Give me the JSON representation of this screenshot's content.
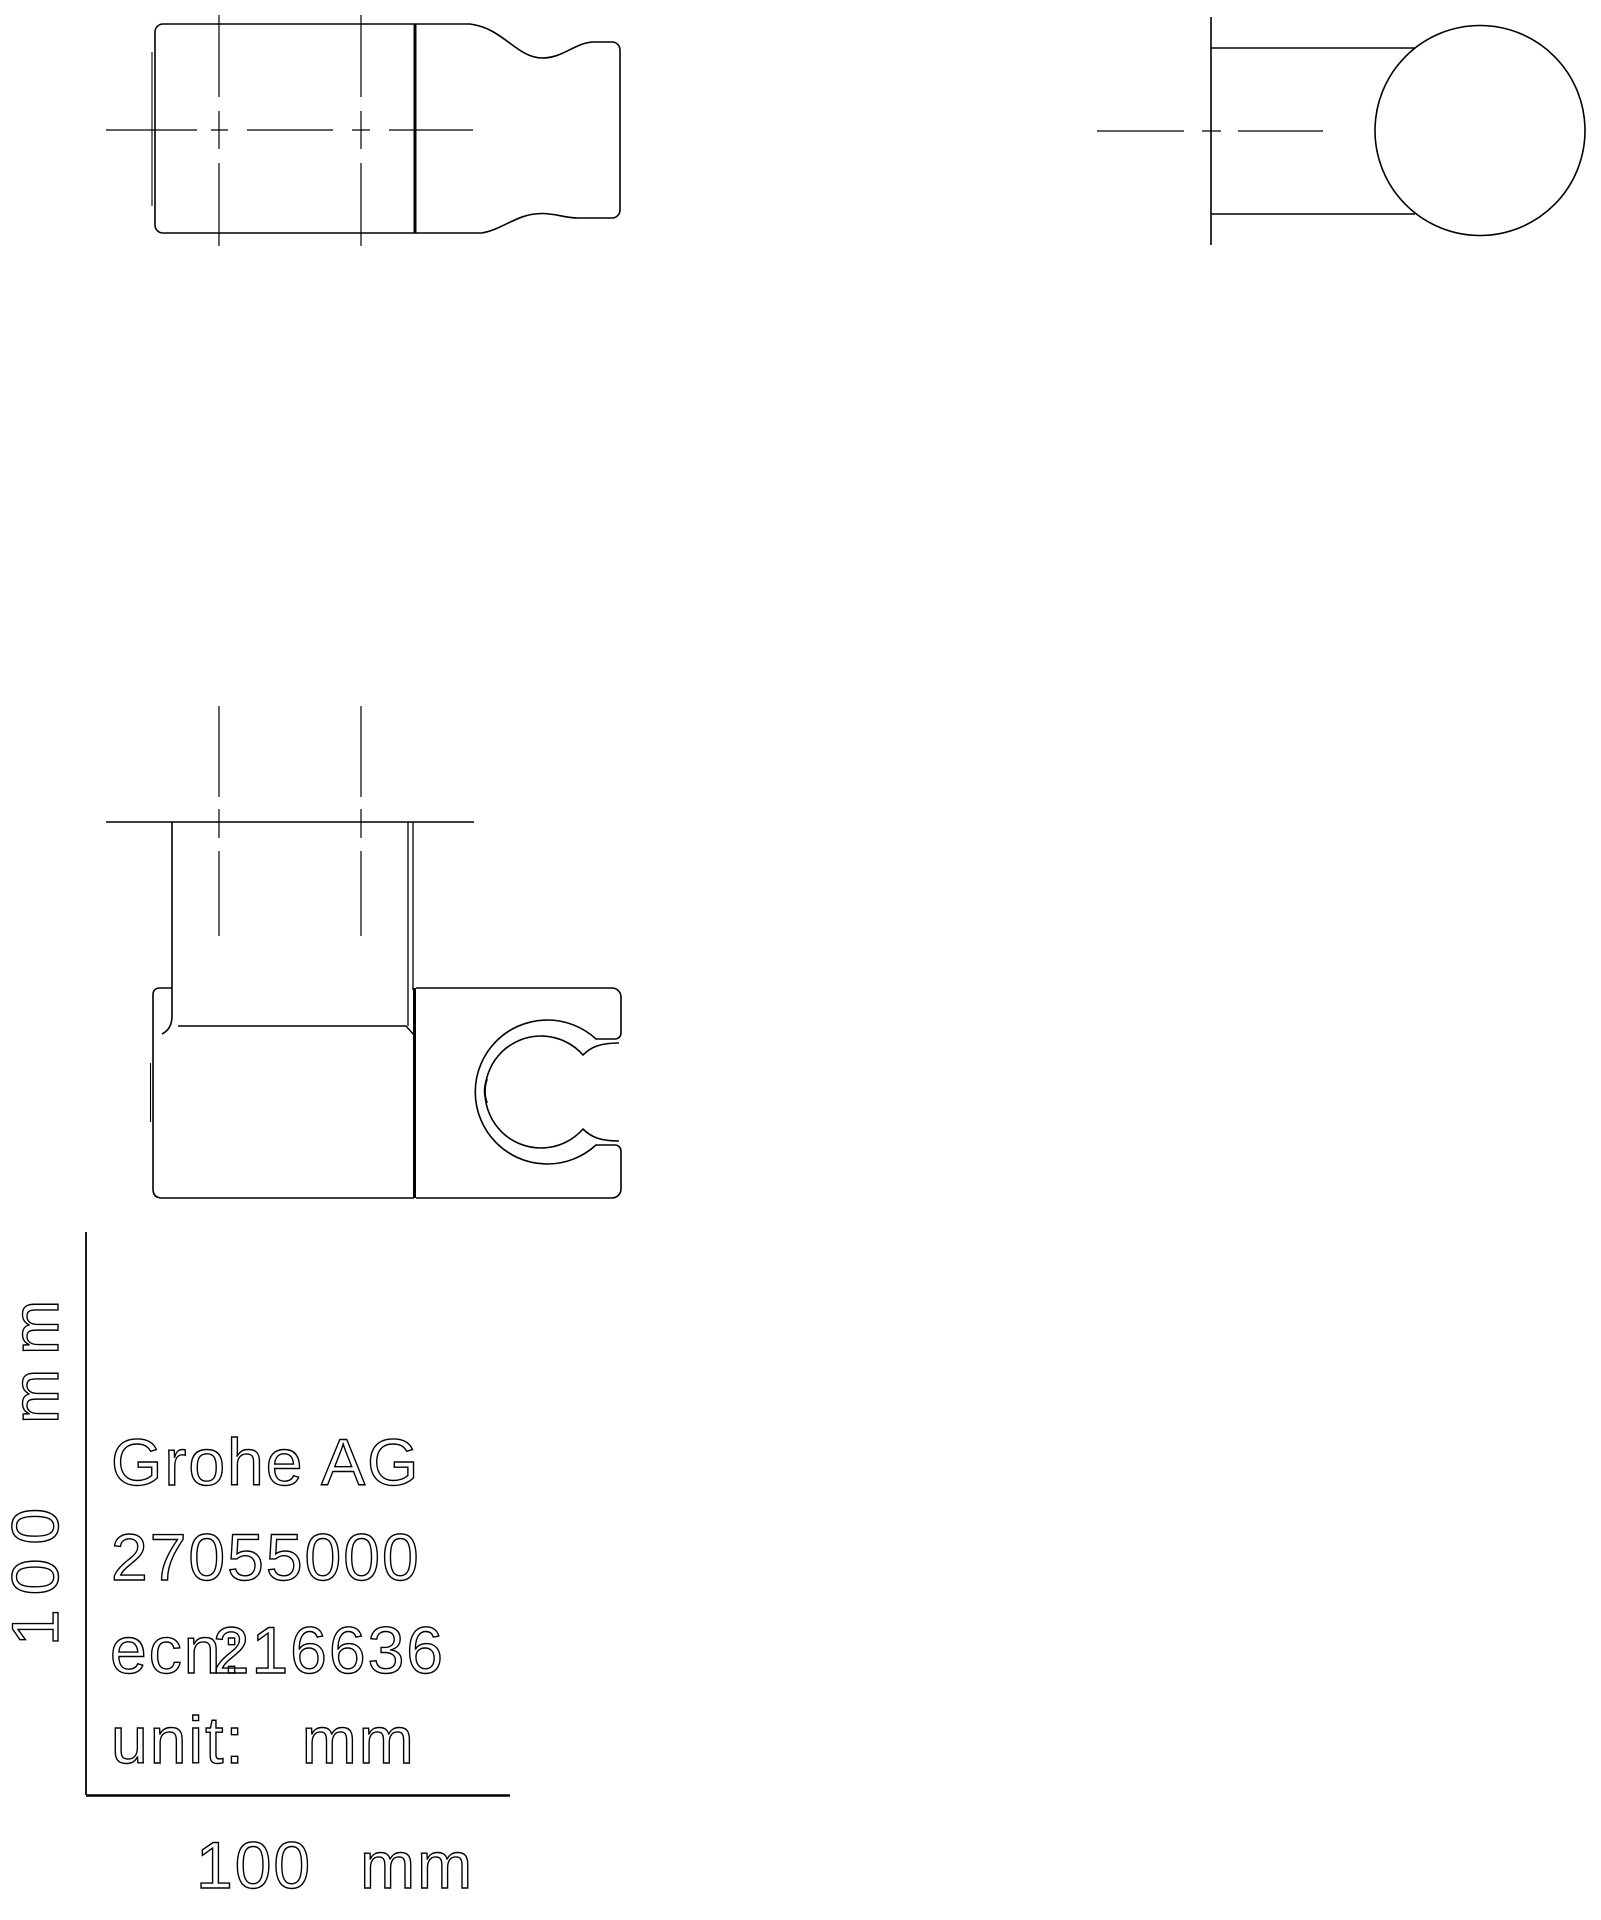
{
  "title_block": {
    "manufacturer": "Grohe AG",
    "product_number": "27055000",
    "ecn_label": "ecn:",
    "ecn_number": "216636",
    "unit_label": "unit:",
    "unit_value": "mm"
  },
  "scale_bar": {
    "vertical_value": "100",
    "vertical_unit": "mm",
    "horizontal_value": "100",
    "horizontal_unit": "mm"
  },
  "drawing": {
    "views": [
      "top-view",
      "side-view",
      "front-view"
    ],
    "line_color": "#000000",
    "background_color": "#ffffff"
  }
}
